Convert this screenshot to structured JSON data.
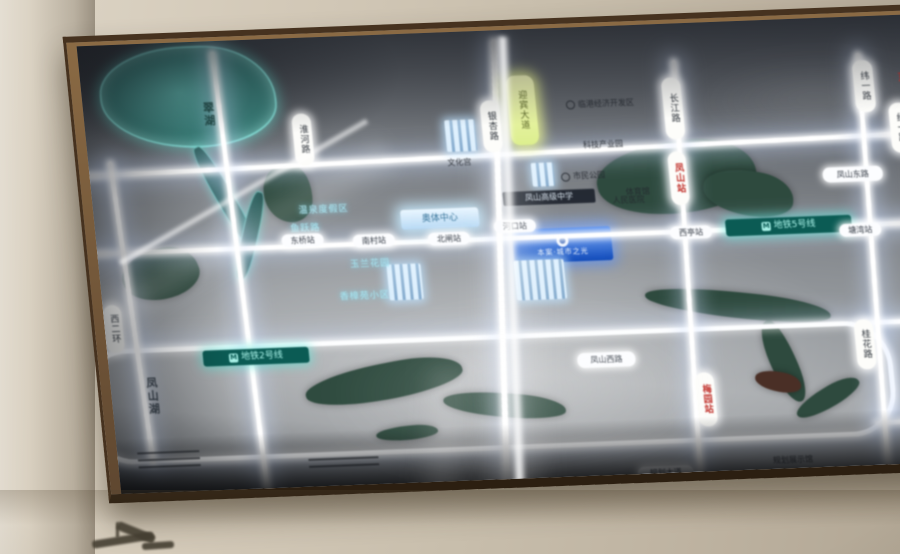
{
  "map": {
    "plaque": {
      "text": "本案·城市之光",
      "logo": "ring-logo",
      "bg": "#1456c8"
    },
    "lake_label": "翠湖",
    "waterside_label": "凤山湖",
    "labels": [
      {
        "name": "road-pill-yingbin-ave",
        "type": "pill-v yellow",
        "text": "迎宾大道",
        "x": 424,
        "y": 46,
        "w": 26,
        "h": 64
      },
      {
        "name": "road-pill-yinxing",
        "type": "pill-v",
        "text": "银杏路",
        "x": 396,
        "y": 70,
        "w": 17,
        "h": 46
      },
      {
        "name": "road-pill-changjiang",
        "type": "pill-v",
        "text": "长江路",
        "x": 579,
        "y": 54,
        "w": 17,
        "h": 56
      },
      {
        "name": "station-pill-fengshan",
        "type": "pill-v station",
        "text": "凤山站",
        "x": 578,
        "y": 128,
        "w": 16,
        "h": 48
      },
      {
        "name": "road-pill-weiyi",
        "type": "pill-v",
        "text": "纬一路",
        "x": 771,
        "y": 44,
        "w": 18,
        "h": 46
      },
      {
        "name": "road-pill-jingyi",
        "type": "pill-v",
        "text": "经一路",
        "x": 803,
        "y": 88,
        "w": 18,
        "h": 44
      },
      {
        "name": "edge-red-char",
        "type": "red-t",
        "text": "东",
        "x": 814,
        "y": 54,
        "w": 14,
        "h": 16
      },
      {
        "name": "road-pill-huaihe",
        "type": "pill-v",
        "text": "淮河路",
        "x": 207,
        "y": 76,
        "w": 17,
        "h": 46
      },
      {
        "name": "station-pill-meiyuan",
        "type": "pill-v station",
        "text": "梅园站",
        "x": 583,
        "y": 350,
        "w": 17,
        "h": 48
      },
      {
        "name": "road-pill-guihua",
        "type": "pill-v",
        "text": "桂花路",
        "x": 747,
        "y": 303,
        "w": 17,
        "h": 44
      },
      {
        "name": "road-pill-xierhuan",
        "type": "pill-v",
        "text": "西二环",
        "x": 0,
        "y": 260,
        "w": 16,
        "h": 42
      },
      {
        "name": "lake-name",
        "type": "lake-t",
        "text": "翠湖",
        "x": 118,
        "y": 52,
        "w": 14,
        "h": 42
      },
      {
        "name": "waterside-name",
        "type": "dark-v",
        "text": "凤山湖",
        "x": 34,
        "y": 329,
        "w": 14,
        "h": 46
      },
      {
        "name": "metro-line-2-label",
        "type": "metro",
        "text": "地铁2号线",
        "icon": "metro-icon",
        "x": 95,
        "y": 309,
        "w": 100,
        "h": 14
      },
      {
        "name": "metro-line-5-label",
        "type": "metro",
        "text": "地铁5号线",
        "icon": "metro-icon",
        "x": 629,
        "y": 198,
        "w": 120,
        "h": 15
      },
      {
        "name": "poi-hot-spring",
        "type": "cyan-t",
        "text": "温泉度假区",
        "x": 190,
        "y": 167,
        "w": 80,
        "h": 12
      },
      {
        "name": "poi-yuyue-road",
        "type": "cyan-t",
        "text": "鱼跃路",
        "x": 186,
        "y": 186,
        "w": 48,
        "h": 11
      },
      {
        "name": "poi-yulan-garden",
        "type": "cyan-t",
        "text": "玉兰花园",
        "x": 226,
        "y": 223,
        "w": 90,
        "h": 12
      },
      {
        "name": "poi-xiangzhang-estate",
        "type": "cyan-t",
        "text": "香樟苑小区",
        "x": 215,
        "y": 255,
        "w": 95,
        "h": 12
      },
      {
        "name": "poi-sports-center",
        "type": "glow-box",
        "text": "奥体中心",
        "x": 306,
        "y": 176,
        "w": 78,
        "h": 20
      },
      {
        "name": "poi-high-school",
        "type": "dark-chip",
        "text": "凤山高级中学",
        "x": 410,
        "y": 162,
        "w": 86,
        "h": 12
      },
      {
        "name": "poi-lingang-zone",
        "type": "dark-t",
        "text": "临港经济开发区",
        "icon": "dot-icon",
        "x": 466,
        "y": 72,
        "w": 100,
        "h": 11
      },
      {
        "name": "poi-citizen-park",
        "type": "dark-t",
        "text": "市民公园",
        "icon": "dot-icon",
        "x": 462,
        "y": 144,
        "w": 60,
        "h": 10
      },
      {
        "name": "poi-gymnasium",
        "type": "dark-t",
        "text": "体育馆",
        "x": 525,
        "y": 162,
        "w": 40,
        "h": 10
      },
      {
        "name": "poi-culture-palace",
        "type": "dark-t",
        "text": "文化宫",
        "x": 350,
        "y": 126,
        "w": 40,
        "h": 10
      },
      {
        "name": "poi-hospital",
        "type": "dark-t",
        "text": "人民医院",
        "x": 512,
        "y": 170,
        "w": 46,
        "h": 10
      },
      {
        "name": "poi-industry-park",
        "type": "dark-t",
        "text": "科技产业园",
        "x": 486,
        "y": 114,
        "w": 58,
        "h": 10
      },
      {
        "name": "poi-planning-hall",
        "type": "dark-t",
        "text": "规划展示馆",
        "x": 645,
        "y": 436,
        "w": 56,
        "h": 10
      },
      {
        "name": "road-pill-fengshan-west",
        "type": "pill-h",
        "text": "凤山西路",
        "x": 468,
        "y": 326,
        "w": 52,
        "h": 13
      },
      {
        "name": "road-pill-fengshan-east",
        "type": "pill-h",
        "text": "凤山东路",
        "x": 731,
        "y": 150,
        "w": 54,
        "h": 13
      },
      {
        "name": "road-pill-guihua-ave",
        "type": "pill-h",
        "text": "规划大道",
        "x": 517,
        "y": 442,
        "w": 50,
        "h": 12
      },
      {
        "name": "stop-pill-dongqiao",
        "type": "pill-h",
        "text": "东桥站",
        "x": 185,
        "y": 196,
        "w": 36,
        "h": 11
      },
      {
        "name": "stop-pill-nancun",
        "type": "pill-h",
        "text": "南村站",
        "x": 256,
        "y": 199,
        "w": 36,
        "h": 11
      },
      {
        "name": "stop-pill-beizha",
        "type": "pill-h",
        "text": "北闸站",
        "x": 331,
        "y": 200,
        "w": 36,
        "h": 11
      },
      {
        "name": "stop-pill-hekou",
        "type": "pill-h",
        "text": "河口站",
        "x": 398,
        "y": 190,
        "w": 36,
        "h": 11
      },
      {
        "name": "stop-pill-xiting",
        "type": "pill-h",
        "text": "西亭站",
        "x": 573,
        "y": 203,
        "w": 36,
        "h": 11
      },
      {
        "name": "stop-pill-tangwan",
        "type": "pill-h",
        "text": "塘湾站",
        "x": 742,
        "y": 207,
        "w": 36,
        "h": 11
      },
      {
        "name": "legend-lines-1",
        "type": "lines",
        "text": "",
        "x": 20,
        "y": 408,
        "w": 62,
        "h": 18
      },
      {
        "name": "legend-lines-2",
        "type": "lines",
        "text": "",
        "x": 190,
        "y": 421,
        "w": 70,
        "h": 14
      }
    ],
    "roads": [
      {
        "t": "h",
        "x": -10,
        "y": 122,
        "w": 860,
        "h": 5,
        "rot": -0.8
      },
      {
        "t": "h",
        "x": -10,
        "y": 206,
        "w": 860,
        "h": 5,
        "rot": 0
      },
      {
        "t": "ring",
        "x": -28,
        "y": 304,
        "w": 800,
        "h": 106
      },
      {
        "t": "h",
        "x": 758,
        "y": 304,
        "w": 100,
        "h": 5,
        "rot": 0
      },
      {
        "t": "h",
        "x": 758,
        "y": 404,
        "w": 100,
        "h": 5,
        "rot": -1
      },
      {
        "t": "v",
        "x": 26,
        "y": 116,
        "h": 305,
        "w": 5,
        "rot": -2.5
      },
      {
        "t": "v",
        "x": 138,
        "y": 10,
        "h": 452,
        "w": 5,
        "rot": -1.5
      },
      {
        "t": "v",
        "x": 398,
        "y": 8,
        "h": 450,
        "w": 6,
        "rot": 4
      },
      {
        "t": "v",
        "x": 584,
        "y": 36,
        "h": 424,
        "w": 5,
        "rot": 2
      },
      {
        "t": "v",
        "x": 770,
        "y": 36,
        "h": 420,
        "w": 5,
        "rot": 1.5
      }
    ],
    "water": [
      {
        "name": "lake",
        "cls": "teal",
        "x": 18,
        "y": 4,
        "w": 172,
        "h": 98,
        "rot": 0
      },
      {
        "name": "stream-upper",
        "cls": "teal-stream",
        "x": 124,
        "y": 100,
        "w": 16,
        "h": 112,
        "rot": -25
      },
      {
        "name": "stream-lower",
        "cls": "teal-stream",
        "x": 146,
        "y": 150,
        "w": 14,
        "h": 90,
        "rot": 18
      },
      {
        "name": "grove",
        "cls": "",
        "x": 172,
        "y": 126,
        "w": 48,
        "h": 58,
        "rot": 0
      },
      {
        "name": "park-east",
        "cls": "",
        "x": 505,
        "y": 118,
        "w": 160,
        "h": 72,
        "rot": -6
      },
      {
        "name": "park-east-b",
        "cls": "",
        "x": 610,
        "y": 150,
        "w": 90,
        "h": 45,
        "rot": 10
      },
      {
        "name": "park-west",
        "cls": "",
        "x": 22,
        "y": 206,
        "w": 78,
        "h": 50,
        "rot": -14
      },
      {
        "name": "river-south-a",
        "cls": "",
        "x": 193,
        "y": 329,
        "w": 160,
        "h": 36,
        "rot": -9
      },
      {
        "name": "river-south-b",
        "cls": "",
        "x": 330,
        "y": 363,
        "w": 122,
        "h": 24,
        "rot": 6
      },
      {
        "name": "river-south-c",
        "cls": "",
        "x": 260,
        "y": 392,
        "w": 62,
        "h": 14,
        "rot": -4
      },
      {
        "name": "river-east-a",
        "cls": "",
        "x": 541,
        "y": 271,
        "w": 185,
        "h": 26,
        "rot": 8
      },
      {
        "name": "river-east-b",
        "cls": "",
        "x": 660,
        "y": 299,
        "w": 26,
        "h": 86,
        "rot": -18
      },
      {
        "name": "river-east-c",
        "cls": "",
        "x": 678,
        "y": 370,
        "w": 72,
        "h": 20,
        "rot": -28
      },
      {
        "name": "red-patch",
        "cls": "red",
        "x": 643,
        "y": 352,
        "w": 46,
        "h": 20,
        "rot": 12
      }
    ],
    "buildings": [
      {
        "x": 359,
        "y": 88,
        "w": 30,
        "h": 32
      },
      {
        "x": 414,
        "y": 231,
        "w": 50,
        "h": 40
      },
      {
        "x": 287,
        "y": 230,
        "w": 34,
        "h": 36
      },
      {
        "x": 441,
        "y": 134,
        "w": 22,
        "h": 24
      }
    ],
    "streaks": [
      {
        "name": "glare-diagonal",
        "x": 6,
        "y": 149,
        "w": 292,
        "h": 6,
        "rot": -27,
        "op": 0.95,
        "blur": 2,
        "dir": "h"
      },
      {
        "name": "glare-diagonal-soft",
        "x": -12,
        "y": 168,
        "w": 330,
        "h": 50,
        "rot": -27,
        "op": 0.17,
        "blur": 8,
        "dir": "h"
      },
      {
        "name": "glare-vertical",
        "x": 404,
        "y": 6,
        "w": 14,
        "h": 480,
        "rot": 3.5,
        "op": 0.92,
        "blur": 2,
        "dir": "v"
      },
      {
        "name": "glare-vertical-soft",
        "x": 360,
        "y": 130,
        "w": 85,
        "h": 360,
        "rot": 5,
        "op": 0.2,
        "blur": 10,
        "dir": "v"
      },
      {
        "name": "glare-lower-soft",
        "x": 298,
        "y": 335,
        "w": 60,
        "h": 140,
        "rot": 9,
        "op": 0.14,
        "blur": 10,
        "dir": "v"
      },
      {
        "name": "haze-top-right",
        "x": 560,
        "y": 26,
        "w": 340,
        "h": 110,
        "rot": 0,
        "op": 0.1,
        "blur": 14,
        "dir": "r"
      },
      {
        "name": "overexposure-wash",
        "x": 140,
        "y": 250,
        "w": 540,
        "h": 220,
        "rot": 0,
        "op": 0.2,
        "blur": 18,
        "dir": "r"
      }
    ],
    "colors": {
      "road_glow": "#ffffff",
      "water_dark": "#2e4a3e",
      "water_teal": "#3a7d78",
      "metro": "#0b5b54",
      "metro_text": "#a9f2e8",
      "plaque_blue": "#1456c8",
      "pill_yellow": "#e9f0a0",
      "frame_bronze": "#6f563a",
      "wall": "#cdc3b2"
    }
  }
}
